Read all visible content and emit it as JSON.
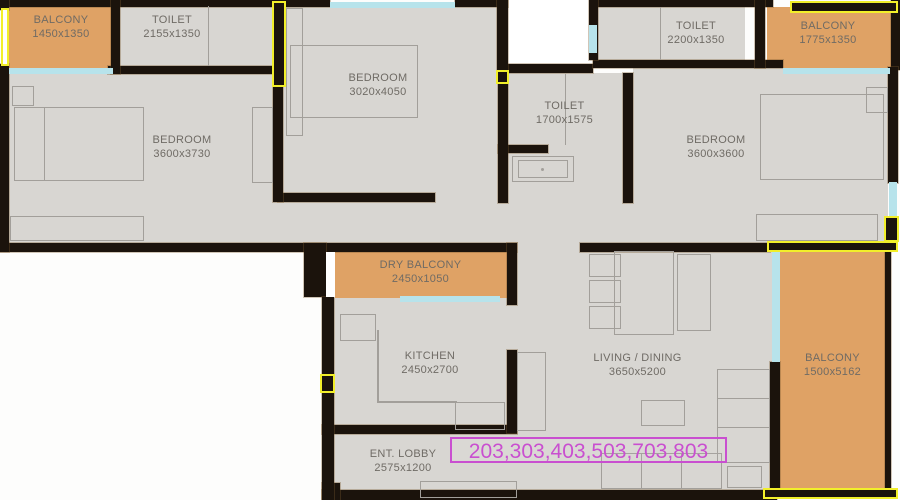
{
  "title": "2BHK apartment floor plan",
  "colors": {
    "floor": "#d8d6d2",
    "wall": "#1b130c",
    "balcony_fill": "#dfa265",
    "window": "#b7e3eb",
    "column_marker": "#f2ef2a",
    "furniture_line": "#a29f9a",
    "label_text": "#6f6b65",
    "highlight": "#c94fd0"
  },
  "rooms": [
    {
      "id": "balcony-top-left",
      "name": "BALCONY",
      "dims": "1450x1350"
    },
    {
      "id": "toilet-top-left",
      "name": "TOILET",
      "dims": "2155x1350"
    },
    {
      "id": "bedroom-top",
      "name": "BEDROOM",
      "dims": "3020x4050"
    },
    {
      "id": "toilet-top-right",
      "name": "TOILET",
      "dims": "2200x1350"
    },
    {
      "id": "balcony-top-right",
      "name": "BALCONY",
      "dims": "1775x1350"
    },
    {
      "id": "toilet-middle",
      "name": "TOILET",
      "dims": "1700x1575"
    },
    {
      "id": "bedroom-left",
      "name": "BEDROOM",
      "dims": "3600x3730"
    },
    {
      "id": "bedroom-right",
      "name": "BEDROOM",
      "dims": "3600x3600"
    },
    {
      "id": "dry-balcony",
      "name": "DRY BALCONY",
      "dims": "2450x1050"
    },
    {
      "id": "kitchen",
      "name": "KITCHEN",
      "dims": "2450x2700"
    },
    {
      "id": "living-dining",
      "name": "LIVING / DINING",
      "dims": "3650x5200"
    },
    {
      "id": "balcony-right",
      "name": "BALCONY",
      "dims": "1500x5162"
    },
    {
      "id": "entrance-lobby",
      "name": "ENT. LOBBY",
      "dims": "2575x1200"
    }
  ],
  "unit_numbers": {
    "label": "203,303,403,503,703,803"
  }
}
